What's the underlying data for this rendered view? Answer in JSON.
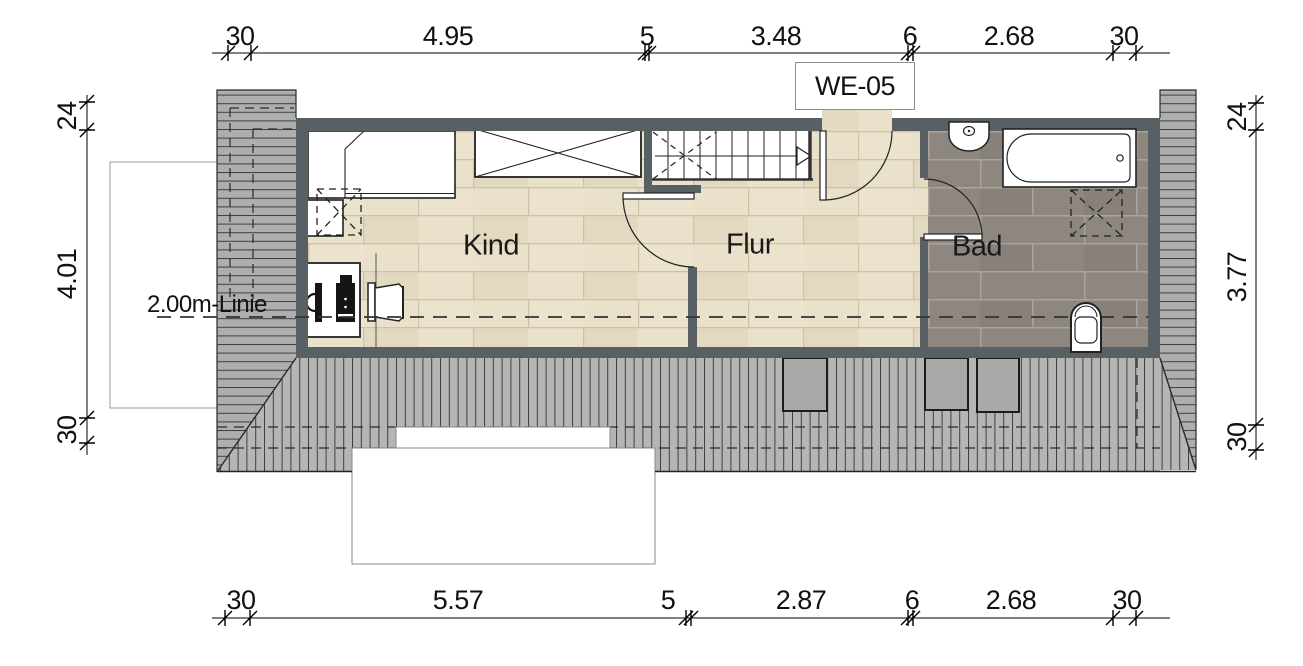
{
  "plan": {
    "unit_label": "WE-05",
    "rooms": {
      "kind": "Kind",
      "flur": "Flur",
      "bad": "Bad"
    },
    "annotations": {
      "two_meter_line": "2.00m-Linie"
    },
    "dimensions": {
      "top": [
        "30",
        "4.95",
        "5",
        "3.48",
        "6",
        "2.68",
        "30"
      ],
      "bottom": [
        "30",
        "5.57",
        "5",
        "2.87",
        "6",
        "2.68",
        "30"
      ],
      "left": [
        "24",
        "4.01",
        "30"
      ],
      "right": [
        "24",
        "3.77",
        "30"
      ]
    },
    "colors": {
      "wall": "#596063",
      "wood_floor": "#eae1cb",
      "bath_floor": "#8d8780",
      "roof": "#b5b5b5",
      "gable": "#aeaeae",
      "line": "#222222"
    }
  }
}
